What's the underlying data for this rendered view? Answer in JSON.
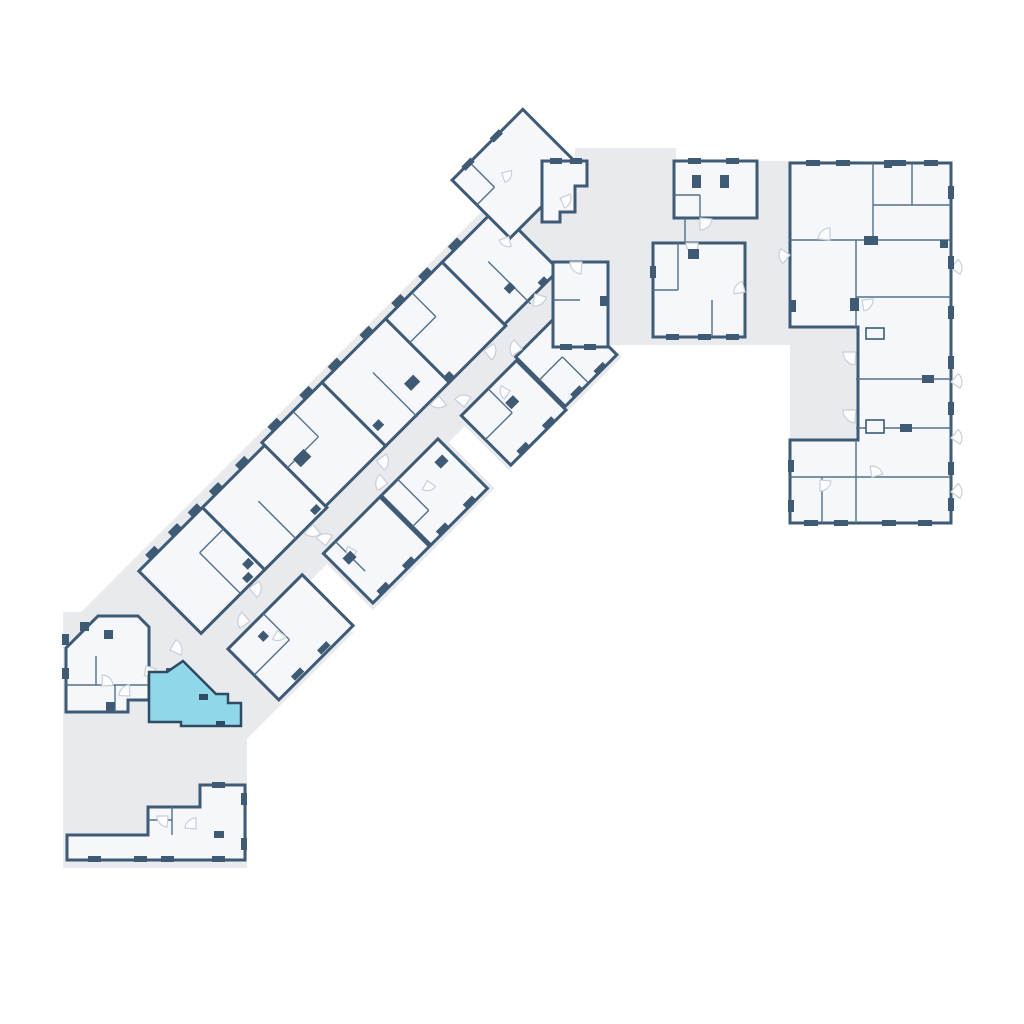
{
  "floor_plan": {
    "canvas": {
      "width": 1024,
      "height": 1024,
      "background": "#ffffff"
    },
    "palette": {
      "corridor_fill": "#e8eaed",
      "room_fill": "#f5f7fa",
      "wall_color": "#3e5a75",
      "partition_color": "#54708a",
      "door_stroke": "#c9cfd6",
      "door_fill": "#fbfcfd",
      "highlight_fill": "#90d7e9",
      "highlight_stroke": "#2e4b63"
    },
    "gray_shapes": [
      {
        "name": "corridor-top-band",
        "path": "M560,161 H858 V345 H560 Z"
      },
      {
        "name": "corridor-top-bump",
        "path": "M575,148 H676 V208 H575 Z"
      },
      {
        "name": "corridor-right-notch",
        "path": "M790,327 H858 V440 H790 Z"
      },
      {
        "name": "corridor-bottom-block",
        "path": "M63,612 H247 V868 H63 Z"
      }
    ],
    "diagonal_wing": {
      "transform": "translate(95,615) rotate(-45)",
      "strip": [
        [
          -10,
          -12,
          655,
          140
        ]
      ],
      "pads": [
        [
          15,
          115,
          155,
          80
        ],
        [
          200,
          115,
          172,
          78
        ],
        [
          395,
          115,
          160,
          75
        ],
        [
          560,
          115,
          62,
          65
        ]
      ],
      "rooms": [
        [
          62,
          0,
          90,
          88
        ],
        [
          152,
          0,
          88,
          88
        ],
        [
          240,
          -4,
          85,
          90
        ],
        [
          325,
          -4,
          90,
          90
        ],
        [
          415,
          -4,
          80,
          90
        ],
        [
          495,
          -4,
          77,
          88
        ],
        [
          560,
          -55,
          100,
          82
        ],
        [
          70,
          118,
          105,
          72
        ],
        [
          205,
          118,
          80,
          70
        ],
        [
          287,
          118,
          80,
          70
        ],
        [
          400,
          118,
          78,
          70
        ],
        [
          480,
          115,
          73,
          70
        ]
      ],
      "partitions": [
        [
          118,
          30,
          118,
          88
        ],
        [
          118,
          30,
          152,
          30
        ],
        [
          196,
          35,
          196,
          88
        ],
        [
          240,
          32,
          284,
          32
        ],
        [
          284,
          -4,
          284,
          32
        ],
        [
          368,
          25,
          368,
          88
        ],
        [
          452,
          -4,
          452,
          30
        ],
        [
          415,
          30,
          452,
          30
        ],
        [
          528,
          28,
          528,
          88
        ],
        [
          585,
          -55,
          585,
          -20
        ],
        [
          560,
          -20,
          585,
          -20
        ],
        [
          120,
          118,
          120,
          155
        ],
        [
          70,
          155,
          120,
          155
        ],
        [
          222,
          118,
          222,
          160
        ],
        [
          310,
          118,
          310,
          162
        ],
        [
          287,
          162,
          310,
          162
        ],
        [
          438,
          118,
          438,
          152
        ],
        [
          400,
          152,
          438,
          152
        ],
        [
          513,
          148,
          513,
          185
        ],
        [
          480,
          148,
          513,
          148
        ]
      ],
      "marks": [
        [
          78,
          -7,
          13,
          6
        ],
        [
          110,
          -7,
          13,
          6
        ],
        [
          138,
          -7,
          13,
          6
        ],
        [
          168,
          -7,
          13,
          6
        ],
        [
          205,
          -7,
          13,
          6
        ],
        [
          255,
          -11,
          13,
          6
        ],
        [
          300,
          -11,
          13,
          6
        ],
        [
          340,
          -11,
          13,
          6
        ],
        [
          385,
          -11,
          13,
          6
        ],
        [
          430,
          -11,
          13,
          6
        ],
        [
          468,
          -11,
          13,
          6
        ],
        [
          510,
          -11,
          13,
          6
        ],
        [
          576,
          -58,
          13,
          6
        ],
        [
          616,
          -58,
          13,
          6
        ],
        [
          250,
          30,
          15,
          11
        ],
        [
          382,
          55,
          13,
          10
        ],
        [
          140,
          68,
          9,
          8
        ],
        [
          330,
          62,
          9,
          8
        ],
        [
          520,
          58,
          9,
          8
        ],
        [
          130,
          78,
          9,
          7
        ],
        [
          226,
          78,
          9,
          7
        ],
        [
          414,
          78,
          9,
          7
        ],
        [
          548,
          78,
          9,
          7
        ],
        [
          95,
          182,
          13,
          6
        ],
        [
          132,
          182,
          13,
          6
        ],
        [
          216,
          182,
          13,
          6
        ],
        [
          252,
          182,
          13,
          6
        ],
        [
          300,
          182,
          13,
          6
        ],
        [
          338,
          182,
          13,
          6
        ],
        [
          414,
          182,
          13,
          6
        ],
        [
          450,
          182,
          13,
          6
        ],
        [
          492,
          180,
          13,
          6
        ],
        [
          525,
          180,
          13,
          6
        ],
        [
          215,
          135,
          11,
          9
        ],
        [
          348,
          132,
          11,
          9
        ],
        [
          440,
          140,
          11,
          9
        ],
        [
          100,
          130,
          8,
          8
        ]
      ],
      "doors": [
        [
          128,
          90,
          12,
          10
        ],
        [
          218,
          90,
          12,
          95
        ],
        [
          308,
          90,
          12,
          10
        ],
        [
          398,
          88,
          12,
          95
        ],
        [
          462,
          88,
          12,
          10
        ],
        [
          538,
          84,
          12,
          60
        ],
        [
          105,
          114,
          12,
          190
        ],
        [
          212,
          114,
          12,
          265
        ],
        [
          300,
          114,
          12,
          190
        ],
        [
          408,
          114,
          12,
          265
        ],
        [
          490,
          114,
          12,
          190
        ],
        [
          118,
          140,
          10,
          80
        ],
        [
          230,
          140,
          10,
          170
        ],
        [
          330,
          140,
          10,
          80
        ],
        [
          452,
          135,
          10,
          170
        ],
        [
          560,
          25,
          10,
          120
        ],
        [
          600,
          -25,
          10,
          30
        ]
      ]
    },
    "orthogonal": {
      "rooms": [
        {
          "name": "unit-top-a",
          "path": "M674,161 H757 V218 H674 Z"
        },
        {
          "name": "unit-top-b",
          "path": "M653,243 H745 V337 H653 Z"
        },
        {
          "name": "unit-top-c",
          "path": "M542,161 H587 V186 H575 V212 H560 V222 H542 Z"
        },
        {
          "name": "unit-top-d",
          "path": "M553,262 H608 V347 H553 Z"
        },
        {
          "name": "right-wing",
          "path": "M790,163 H951 V523 H790 V440 H858 V327 H790 Z"
        },
        {
          "name": "unit-bottom-left",
          "path": "M66,648 L98,616 H138 L149,627 V700 H128 V712 H66 Z"
        },
        {
          "name": "unit-bottom",
          "path": "M67,835 H148 V807 H200 V785 H245 V860 H67 Z"
        }
      ],
      "partitions": [
        [
          700,
          195,
          700,
          218
        ],
        [
          674,
          195,
          700,
          195
        ],
        [
          685,
          218,
          685,
          243
        ],
        [
          678,
          243,
          678,
          290
        ],
        [
          653,
          290,
          678,
          290
        ],
        [
          712,
          300,
          712,
          337
        ],
        [
          553,
          300,
          580,
          300
        ],
        [
          873,
          163,
          873,
          240
        ],
        [
          790,
          240,
          951,
          240
        ],
        [
          856,
          240,
          856,
          327
        ],
        [
          856,
          440,
          856,
          523
        ],
        [
          856,
          297,
          951,
          297
        ],
        [
          856,
          379,
          951,
          379
        ],
        [
          856,
          428,
          951,
          428
        ],
        [
          790,
          477,
          951,
          477
        ],
        [
          873,
          205,
          951,
          205
        ],
        [
          912,
          163,
          912,
          205
        ],
        [
          822,
          477,
          822,
          523
        ],
        [
          66,
          685,
          148,
          685
        ],
        [
          115,
          685,
          115,
          712
        ],
        [
          96,
          656,
          96,
          685
        ],
        [
          172,
          807,
          172,
          835
        ],
        [
          148,
          820,
          172,
          820
        ]
      ],
      "marks": [
        [
          692,
          175,
          9,
          13
        ],
        [
          720,
          175,
          9,
          13
        ],
        [
          688,
          158,
          13,
          6
        ],
        [
          726,
          158,
          13,
          6
        ],
        [
          688,
          249,
          11,
          10
        ],
        [
          666,
          334,
          13,
          6
        ],
        [
          698,
          334,
          13,
          6
        ],
        [
          726,
          334,
          13,
          6
        ],
        [
          650,
          266,
          6,
          12
        ],
        [
          550,
          158,
          12,
          6
        ],
        [
          570,
          158,
          12,
          6
        ],
        [
          560,
          344,
          12,
          6
        ],
        [
          584,
          344,
          12,
          6
        ],
        [
          600,
          296,
          7,
          10
        ],
        [
          806,
          160,
          14,
          6
        ],
        [
          836,
          160,
          14,
          6
        ],
        [
          892,
          160,
          14,
          6
        ],
        [
          924,
          160,
          14,
          6
        ],
        [
          884,
          160,
          8,
          8
        ],
        [
          948,
          186,
          6,
          13
        ],
        [
          948,
          256,
          6,
          13
        ],
        [
          948,
          306,
          6,
          13
        ],
        [
          948,
          356,
          6,
          13
        ],
        [
          948,
          402,
          6,
          13
        ],
        [
          948,
          462,
          6,
          13
        ],
        [
          948,
          498,
          6,
          13
        ],
        [
          804,
          520,
          14,
          6
        ],
        [
          834,
          520,
          14,
          6
        ],
        [
          882,
          520,
          14,
          6
        ],
        [
          918,
          520,
          14,
          6
        ],
        [
          864,
          236,
          14,
          9
        ],
        [
          850,
          298,
          9,
          13
        ],
        [
          900,
          424,
          12,
          8
        ],
        [
          922,
          375,
          12,
          8
        ],
        [
          940,
          240,
          8,
          8
        ],
        [
          790,
          300,
          6,
          12
        ],
        [
          788,
          460,
          6,
          12
        ],
        [
          788,
          500,
          6,
          12
        ],
        [
          62,
          634,
          7,
          11
        ],
        [
          62,
          668,
          7,
          11
        ],
        [
          104,
          630,
          9,
          9
        ],
        [
          106,
          702,
          9,
          9
        ],
        [
          166,
          668,
          9,
          9
        ],
        [
          80,
          622,
          9,
          9
        ],
        [
          88,
          856,
          13,
          6
        ],
        [
          134,
          856,
          13,
          6
        ],
        [
          161,
          856,
          13,
          6
        ],
        [
          212,
          856,
          13,
          6
        ],
        [
          241,
          793,
          6,
          12
        ],
        [
          241,
          838,
          6,
          12
        ],
        [
          212,
          782,
          13,
          6
        ],
        [
          214,
          831,
          10,
          7
        ]
      ],
      "shafts": [
        [
          866,
          420,
          18,
          13
        ],
        [
          866,
          328,
          18,
          11
        ]
      ],
      "doors": [
        [
          700,
          218,
          12,
          5
        ],
        [
          698,
          243,
          12,
          95
        ],
        [
          745,
          292,
          11,
          170
        ],
        [
          560,
          198,
          11,
          340
        ],
        [
          582,
          262,
          12,
          95
        ],
        [
          856,
          352,
          13,
          95
        ],
        [
          856,
          410,
          13,
          95
        ],
        [
          830,
          240,
          12,
          185
        ],
        [
          862,
          300,
          11,
          355
        ],
        [
          872,
          477,
          11,
          260
        ],
        [
          820,
          480,
          11,
          5
        ],
        [
          790,
          255,
          11,
          130
        ],
        [
          102,
          686,
          11,
          272
        ],
        [
          130,
          696,
          11,
          182
        ],
        [
          170,
          650,
          12,
          300
        ],
        [
          146,
          666,
          10,
          15
        ],
        [
          168,
          816,
          11,
          95
        ],
        [
          196,
          829,
          11,
          185
        ],
        [
          951,
          268,
          11,
          310
        ],
        [
          951,
          382,
          11,
          310
        ],
        [
          951,
          438,
          11,
          310
        ],
        [
          951,
          492,
          11,
          310
        ]
      ]
    },
    "highlight_unit": {
      "name": "selected-unit",
      "path": "M183,661 L216,694 H228 V703 H241 V726 H181 V722 H149 V672 H167 Z",
      "marks": [
        [
          199,
          694,
          9,
          6
        ],
        [
          216,
          721,
          9,
          6
        ]
      ]
    }
  }
}
